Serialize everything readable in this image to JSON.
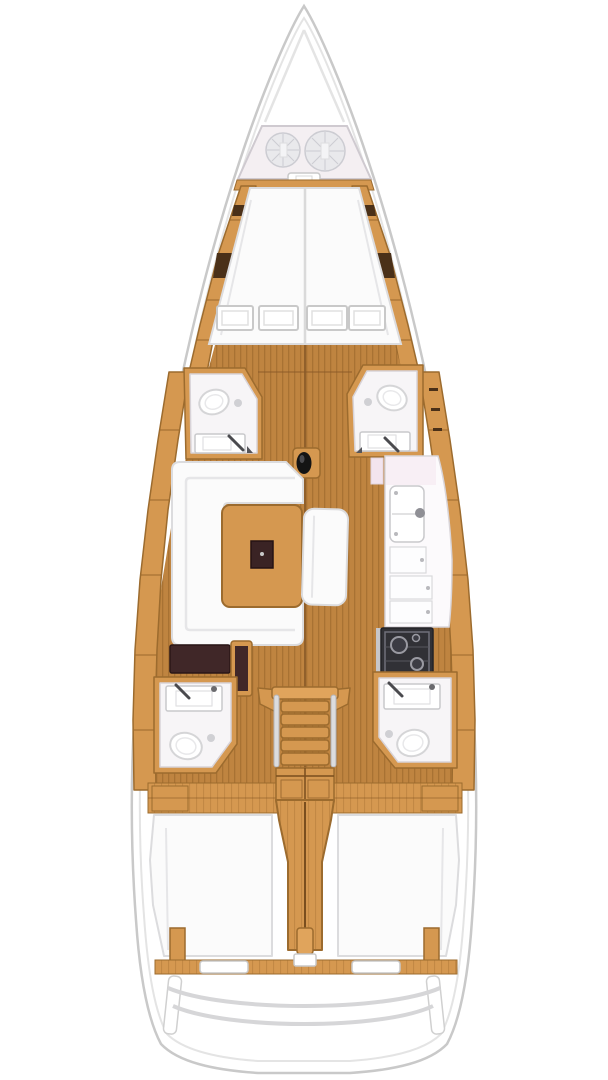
{
  "scene": {
    "type": "yacht-interior-floorplan",
    "subject": "Top-down interior layout plan of a sailing yacht, bow at top, stern at bottom",
    "canvas": {
      "width": 608,
      "height": 1080
    },
    "text_content": "none - drawing only"
  },
  "colors": {
    "bg": "#ffffff",
    "hull_fill": "#ffffff",
    "hull_stroke": "#c9c9c9",
    "hull_inner_stroke": "#e4e4e4",
    "wood": "#d59850",
    "wood_light": "#e0a45c",
    "wood_dark": "#9c6b2e",
    "wood_darker": "#7a4e1e",
    "floor": "#bf8440",
    "floor_line": "#a87233",
    "floor_seam": "#8a5a28",
    "white_furn": "#fbfbfb",
    "furn_stroke": "#dcdcde",
    "seam": "#e6e6e8",
    "room": "#f7f5f7",
    "room_stroke": "#cfcad0",
    "dark_brown": "#402728",
    "darker_brown": "#2a1717",
    "dark_seg": "#4a3018",
    "stove": "#313136",
    "stove_line": "#70707a",
    "metal": "#8f8f95",
    "rail_gray": "#d6d6d8",
    "mast": "#141414",
    "rope": "#e9e9ec",
    "rope_line": "#ccccd2",
    "locker": "#f4eff2",
    "pink_door": "#f3e4ee"
  },
  "areas": {
    "bow": {
      "label": "Bow / anchor locker",
      "items": [
        "anchor-locker",
        "rope-coil-small",
        "rope-coil-large",
        "locker-latch"
      ]
    },
    "forward_cabin": {
      "label": "Forward cabin",
      "items": [
        "v-berth-double",
        "deck-hatches-x4",
        "port-side-rail",
        "starboard-side-rail"
      ]
    },
    "forward_heads": {
      "label": "Forward heads",
      "items": [
        "port-forward-head",
        "port-forward-toilet",
        "port-forward-sink",
        "starboard-forward-head",
        "starboard-forward-toilet",
        "starboard-forward-sink"
      ]
    },
    "saloon": {
      "label": "Saloon",
      "items": [
        "u-shaped-sofa",
        "saloon-table",
        "center-bench",
        "mast-foot"
      ]
    },
    "galley": {
      "label": "Galley (starboard)",
      "items": [
        "galley-counter",
        "double-sink",
        "faucet",
        "locker-doors",
        "stove"
      ]
    },
    "nav_station": {
      "label": "Chart table (port)",
      "items": [
        "chart-table",
        "navigator-seat"
      ]
    },
    "companionway": {
      "label": "Companionway",
      "items": [
        "steps",
        "handrail-port",
        "handrail-starboard",
        "step-locker"
      ]
    },
    "aft_heads": {
      "label": "Aft heads",
      "items": [
        "port-aft-head",
        "port-aft-toilet",
        "port-aft-sink",
        "starboard-aft-head",
        "starboard-aft-toilet",
        "starboard-aft-sink"
      ]
    },
    "aft_cabins": {
      "label": "Aft cabins",
      "items": [
        "port-aft-berth",
        "starboard-aft-berth",
        "engine-compartment"
      ]
    },
    "stern": {
      "label": "Stern",
      "items": [
        "transom-lockers",
        "swim-platform"
      ]
    }
  }
}
